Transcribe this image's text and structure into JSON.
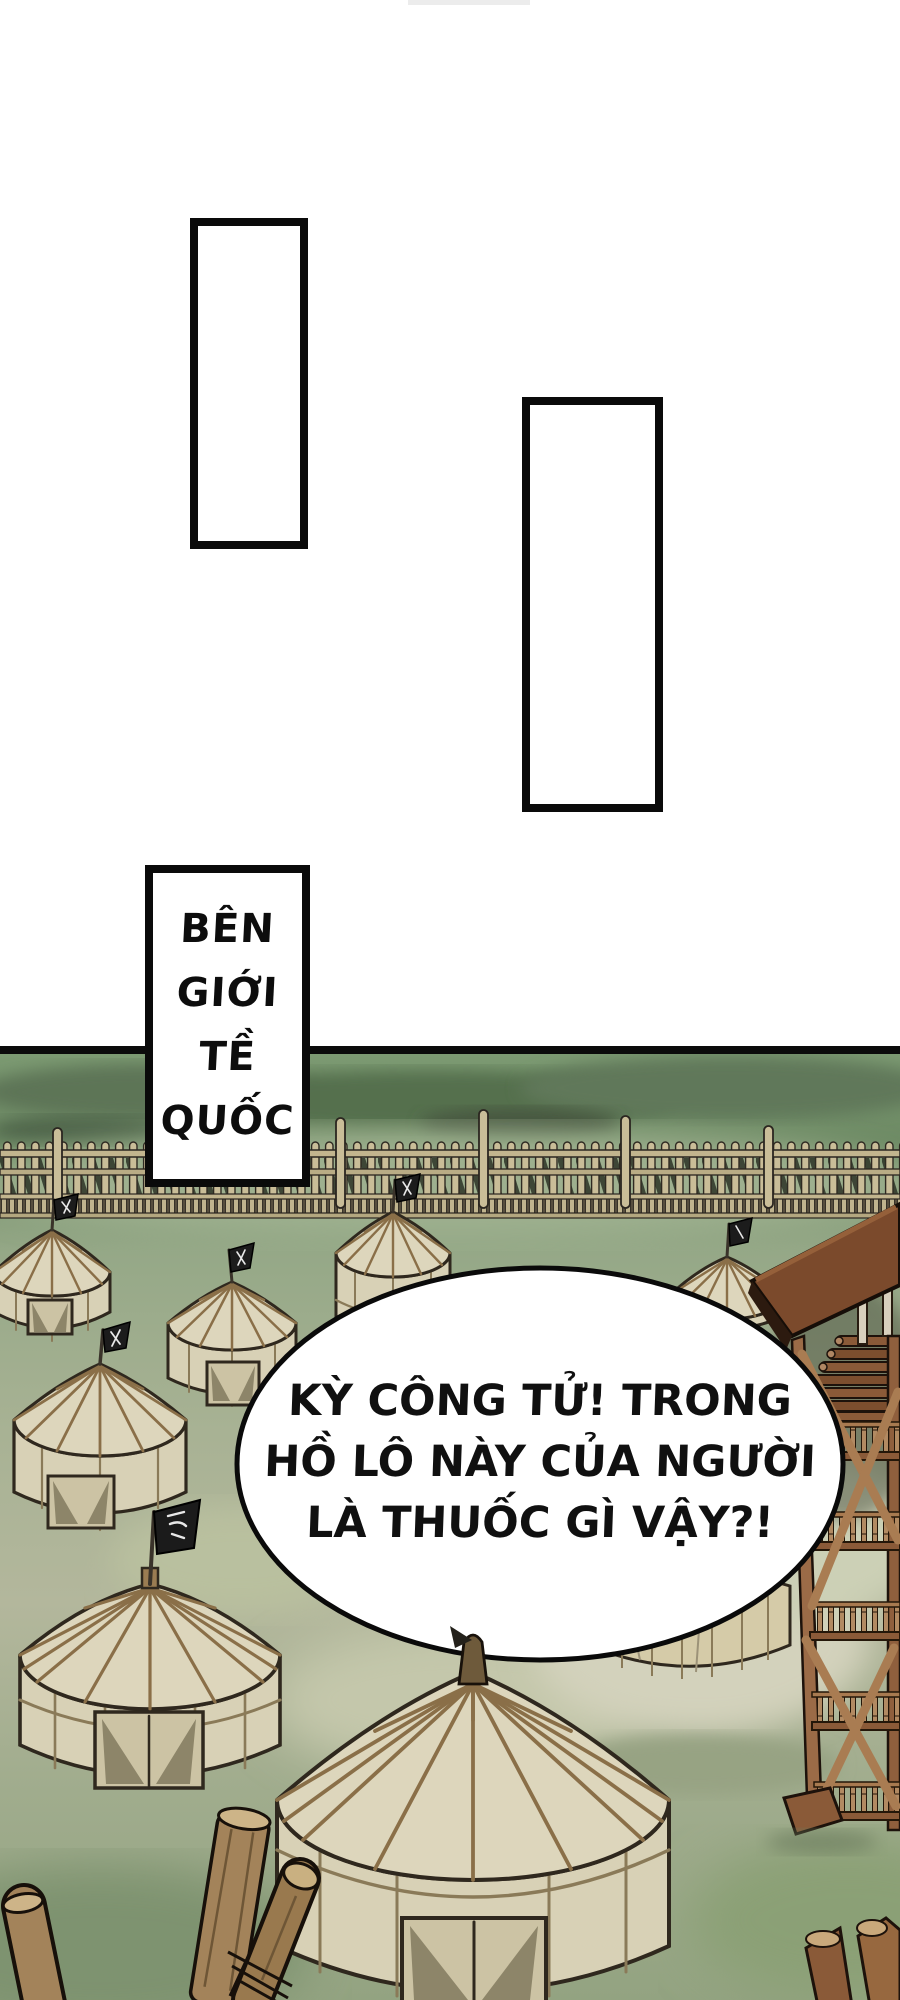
{
  "page": {
    "type": "comic-page",
    "background": "#ffffff"
  },
  "top_panels": {
    "count": 2
  },
  "caption": {
    "lines": [
      "BÊN",
      "GIỚI",
      "TỀ",
      "QUỐC"
    ]
  },
  "bubble": {
    "lines": [
      "KỲ CÔNG TỬ! TRONG",
      "HỒ LÔ NÀY CỦA NGƯỜI",
      "LÀ THUỐC GÌ VẬY?!"
    ]
  },
  "scene": {
    "elements": [
      "palisade-fence",
      "yurt-tents",
      "war-banners",
      "watchtower",
      "log-stakes",
      "grass-field"
    ],
    "colors": {
      "field_green": "#8fa37f",
      "hill_green": "#55704e",
      "fence_wood": "#c9bd98",
      "tent_fabric": "#ddd6bc",
      "tent_beam": "#8a6f48",
      "tower_wood": "#9b6b47",
      "roof_brown": "#7b4a2c",
      "banner_black": "#1c1c1c",
      "outline": "#1d170f",
      "panel_border": "#0a0a0a"
    }
  }
}
